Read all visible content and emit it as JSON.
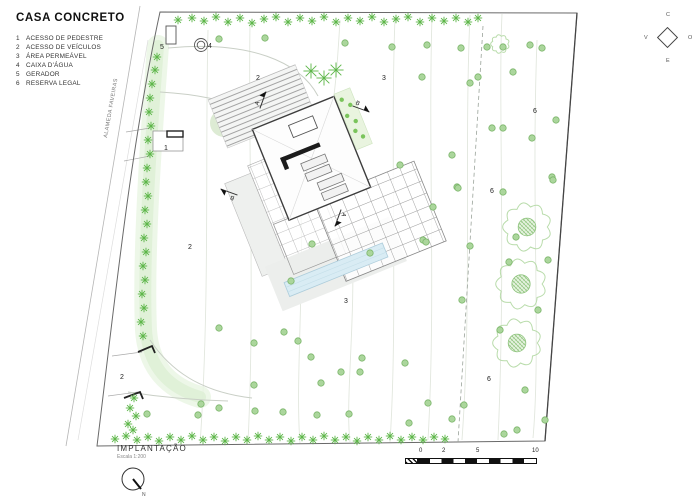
{
  "title": "CASA CONCRETO",
  "legend": {
    "items": [
      {
        "num": "1",
        "label": "ACESSO DE PEDESTRE"
      },
      {
        "num": "2",
        "label": "ACESSO DE VEÍCULOS"
      },
      {
        "num": "3",
        "label": "ÁREA PERMEÁVEL"
      },
      {
        "num": "4",
        "label": "CAIXA D'ÁGUA"
      },
      {
        "num": "5",
        "label": "GERADOR"
      },
      {
        "num": "6",
        "label": "RESERVA LEGAL"
      }
    ]
  },
  "compass": {
    "top": "C",
    "left": "V",
    "right": "O",
    "bottom": "E"
  },
  "street_label": "ALAMEDA FAVEIRAS",
  "drawing": {
    "name": "IMPLANTAÇÃO",
    "scale": "Escala 1:200",
    "north_letter": "N"
  },
  "scale_bar": {
    "labels": [
      {
        "text": "0",
        "x": 14
      },
      {
        "text": "2",
        "x": 37
      },
      {
        "text": "5",
        "x": 71
      },
      {
        "text": "10",
        "x": 127
      }
    ]
  },
  "plan": {
    "colors": {
      "tree_green": "#5cb648",
      "dot_fill": "#abd69c",
      "dot_edge": "#7bb56a",
      "flower_outline": "#b9dcab",
      "pool_blue": "#d9ecf4",
      "contour": "#e2e7de"
    },
    "section_markers": [
      {
        "letter": "A",
        "x": 263,
        "y": 100,
        "angle": -70
      },
      {
        "letter": "B",
        "x": 361,
        "y": 109,
        "angle": 20
      },
      {
        "letter": "B",
        "x": 229,
        "y": 192,
        "angle": 200
      },
      {
        "letter": "A",
        "x": 338,
        "y": 218,
        "angle": 110
      }
    ],
    "area_labels": [
      {
        "text": "5",
        "x": 160,
        "y": 49
      },
      {
        "text": "4",
        "x": 208,
        "y": 48
      },
      {
        "text": "2",
        "x": 256,
        "y": 80
      },
      {
        "text": "3",
        "x": 382,
        "y": 80
      },
      {
        "text": "6",
        "x": 533,
        "y": 113
      },
      {
        "text": "6",
        "x": 490,
        "y": 193
      },
      {
        "text": "1",
        "x": 164,
        "y": 150
      },
      {
        "text": "2",
        "x": 188,
        "y": 249
      },
      {
        "text": "3",
        "x": 344,
        "y": 303
      },
      {
        "text": "6",
        "x": 487,
        "y": 381
      },
      {
        "text": "2",
        "x": 120,
        "y": 379
      }
    ],
    "trees": {
      "asterisks": [
        [
          178,
          20
        ],
        [
          192,
          18
        ],
        [
          204,
          21
        ],
        [
          216,
          17
        ],
        [
          228,
          22
        ],
        [
          240,
          18
        ],
        [
          252,
          23
        ],
        [
          264,
          19
        ],
        [
          276,
          17
        ],
        [
          288,
          22
        ],
        [
          300,
          18
        ],
        [
          312,
          21
        ],
        [
          324,
          17
        ],
        [
          336,
          22
        ],
        [
          348,
          18
        ],
        [
          360,
          21
        ],
        [
          372,
          17
        ],
        [
          384,
          22
        ],
        [
          396,
          19
        ],
        [
          408,
          17
        ],
        [
          420,
          22
        ],
        [
          432,
          18
        ],
        [
          444,
          21
        ],
        [
          456,
          18
        ],
        [
          468,
          22
        ],
        [
          478,
          18
        ],
        [
          157,
          57
        ],
        [
          155,
          70
        ],
        [
          152,
          84
        ],
        [
          150,
          98
        ],
        [
          149,
          112
        ],
        [
          151,
          126
        ],
        [
          148,
          140
        ],
        [
          150,
          154
        ],
        [
          147,
          168
        ],
        [
          146,
          182
        ],
        [
          148,
          196
        ],
        [
          145,
          210
        ],
        [
          147,
          224
        ],
        [
          144,
          238
        ],
        [
          146,
          252
        ],
        [
          143,
          266
        ],
        [
          145,
          280
        ],
        [
          142,
          294
        ],
        [
          144,
          308
        ],
        [
          141,
          322
        ],
        [
          143,
          336
        ],
        [
          134,
          398
        ],
        [
          130,
          408
        ],
        [
          136,
          416
        ],
        [
          128,
          424
        ],
        [
          133,
          430
        ],
        [
          115,
          439
        ],
        [
          126,
          436
        ],
        [
          137,
          440
        ],
        [
          148,
          437
        ],
        [
          159,
          441
        ],
        [
          170,
          437
        ],
        [
          181,
          440
        ],
        [
          192,
          436
        ],
        [
          203,
          440
        ],
        [
          214,
          437
        ],
        [
          225,
          441
        ],
        [
          236,
          437
        ],
        [
          247,
          440
        ],
        [
          258,
          436
        ],
        [
          269,
          440
        ],
        [
          280,
          437
        ],
        [
          291,
          441
        ],
        [
          302,
          437
        ],
        [
          313,
          440
        ],
        [
          324,
          436
        ],
        [
          335,
          440
        ],
        [
          346,
          437
        ],
        [
          357,
          441
        ],
        [
          368,
          437
        ],
        [
          379,
          440
        ],
        [
          390,
          436
        ],
        [
          401,
          440
        ],
        [
          412,
          437
        ],
        [
          423,
          440
        ],
        [
          434,
          437
        ],
        [
          445,
          439
        ]
      ],
      "palms": [
        [
          311,
          71
        ],
        [
          324,
          78
        ],
        [
          336,
          70
        ]
      ],
      "dots": [
        [
          219,
          39
        ],
        [
          265,
          38
        ],
        [
          345,
          43
        ],
        [
          392,
          47
        ],
        [
          427,
          45
        ],
        [
          461,
          48
        ],
        [
          487,
          47
        ],
        [
          503,
          47
        ],
        [
          542,
          48
        ],
        [
          530,
          45
        ],
        [
          422,
          77
        ],
        [
          478,
          77
        ],
        [
          470,
          83
        ],
        [
          513,
          72
        ],
        [
          556,
          120
        ],
        [
          492,
          128
        ],
        [
          503,
          128
        ],
        [
          532,
          138
        ],
        [
          452,
          155
        ],
        [
          400,
          165
        ],
        [
          457,
          187
        ],
        [
          552,
          177
        ],
        [
          553,
          180
        ],
        [
          503,
          192
        ],
        [
          458,
          188
        ],
        [
          433,
          207
        ],
        [
          516,
          237
        ],
        [
          423,
          240
        ],
        [
          426,
          242
        ],
        [
          470,
          246
        ],
        [
          509,
          262
        ],
        [
          548,
          260
        ],
        [
          312,
          244
        ],
        [
          370,
          253
        ],
        [
          291,
          281
        ],
        [
          462,
          300
        ],
        [
          538,
          310
        ],
        [
          219,
          328
        ],
        [
          254,
          343
        ],
        [
          284,
          332
        ],
        [
          298,
          341
        ],
        [
          311,
          357
        ],
        [
          341,
          372
        ],
        [
          360,
          372
        ],
        [
          362,
          358
        ],
        [
          405,
          363
        ],
        [
          254,
          385
        ],
        [
          321,
          383
        ],
        [
          500,
          330
        ],
        [
          525,
          390
        ],
        [
          147,
          414
        ],
        [
          201,
          404
        ],
        [
          198,
          415
        ],
        [
          219,
          408
        ],
        [
          255,
          411
        ],
        [
          283,
          412
        ],
        [
          317,
          415
        ],
        [
          349,
          414
        ],
        [
          409,
          423
        ],
        [
          428,
          403
        ],
        [
          452,
          419
        ],
        [
          464,
          405
        ],
        [
          504,
          434
        ],
        [
          517,
          430
        ],
        [
          545,
          420
        ]
      ],
      "flowers": [
        [
          527,
          227,
          26
        ],
        [
          521,
          284,
          27
        ],
        [
          517,
          343,
          26
        ],
        [
          500,
          44,
          10
        ]
      ]
    }
  }
}
